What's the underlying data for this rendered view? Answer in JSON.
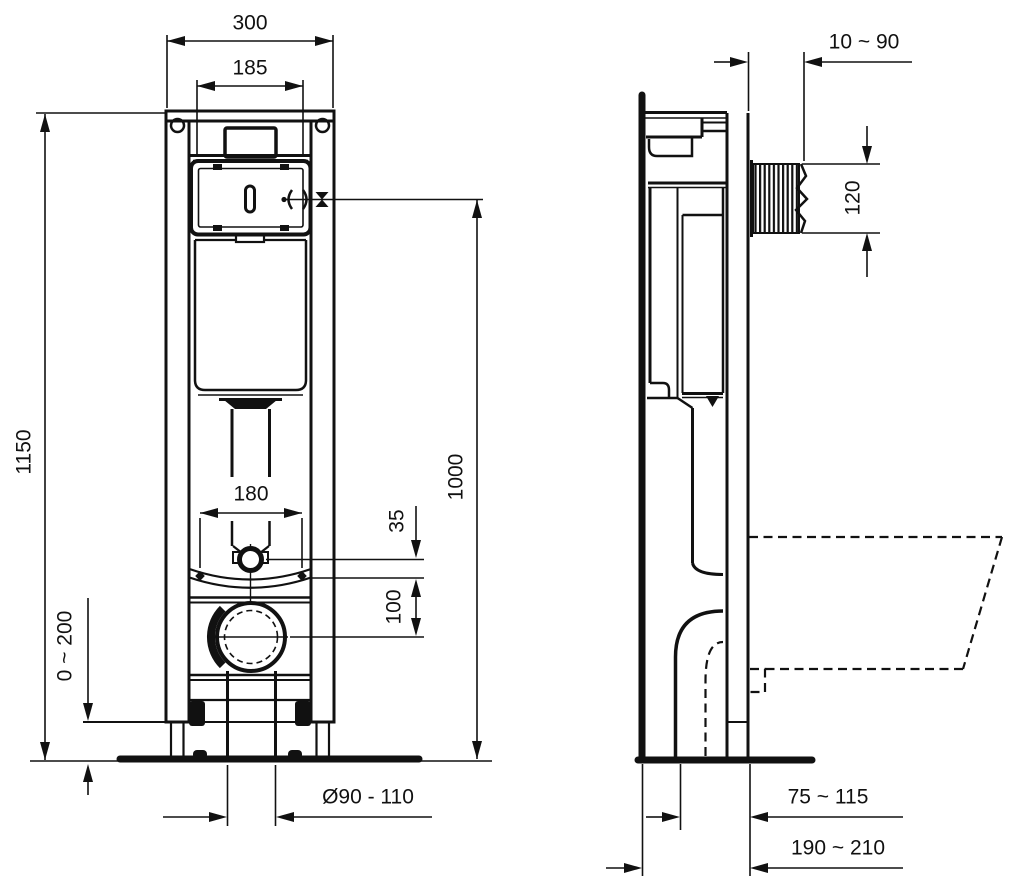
{
  "colors": {
    "ink": "#111111",
    "paper": "#ffffff"
  },
  "front_view": {
    "dimensions": {
      "frame_width": "300",
      "opening_width": "185",
      "frame_height": "1150",
      "flush_line_height": "1000",
      "fixing_bolt_spacing": "180",
      "inlet_offset": "35",
      "inlet_outlet_gap": "100",
      "foot_adjustment": "0 ~ 200",
      "drain_diameter": "Ø90 - 110"
    }
  },
  "side_view": {
    "dimensions": {
      "wall_finish_range": "10 ~ 90",
      "sleeve_height": "120",
      "outlet_depth": "75 ~ 115",
      "frame_depth": "190 ~ 210"
    }
  }
}
